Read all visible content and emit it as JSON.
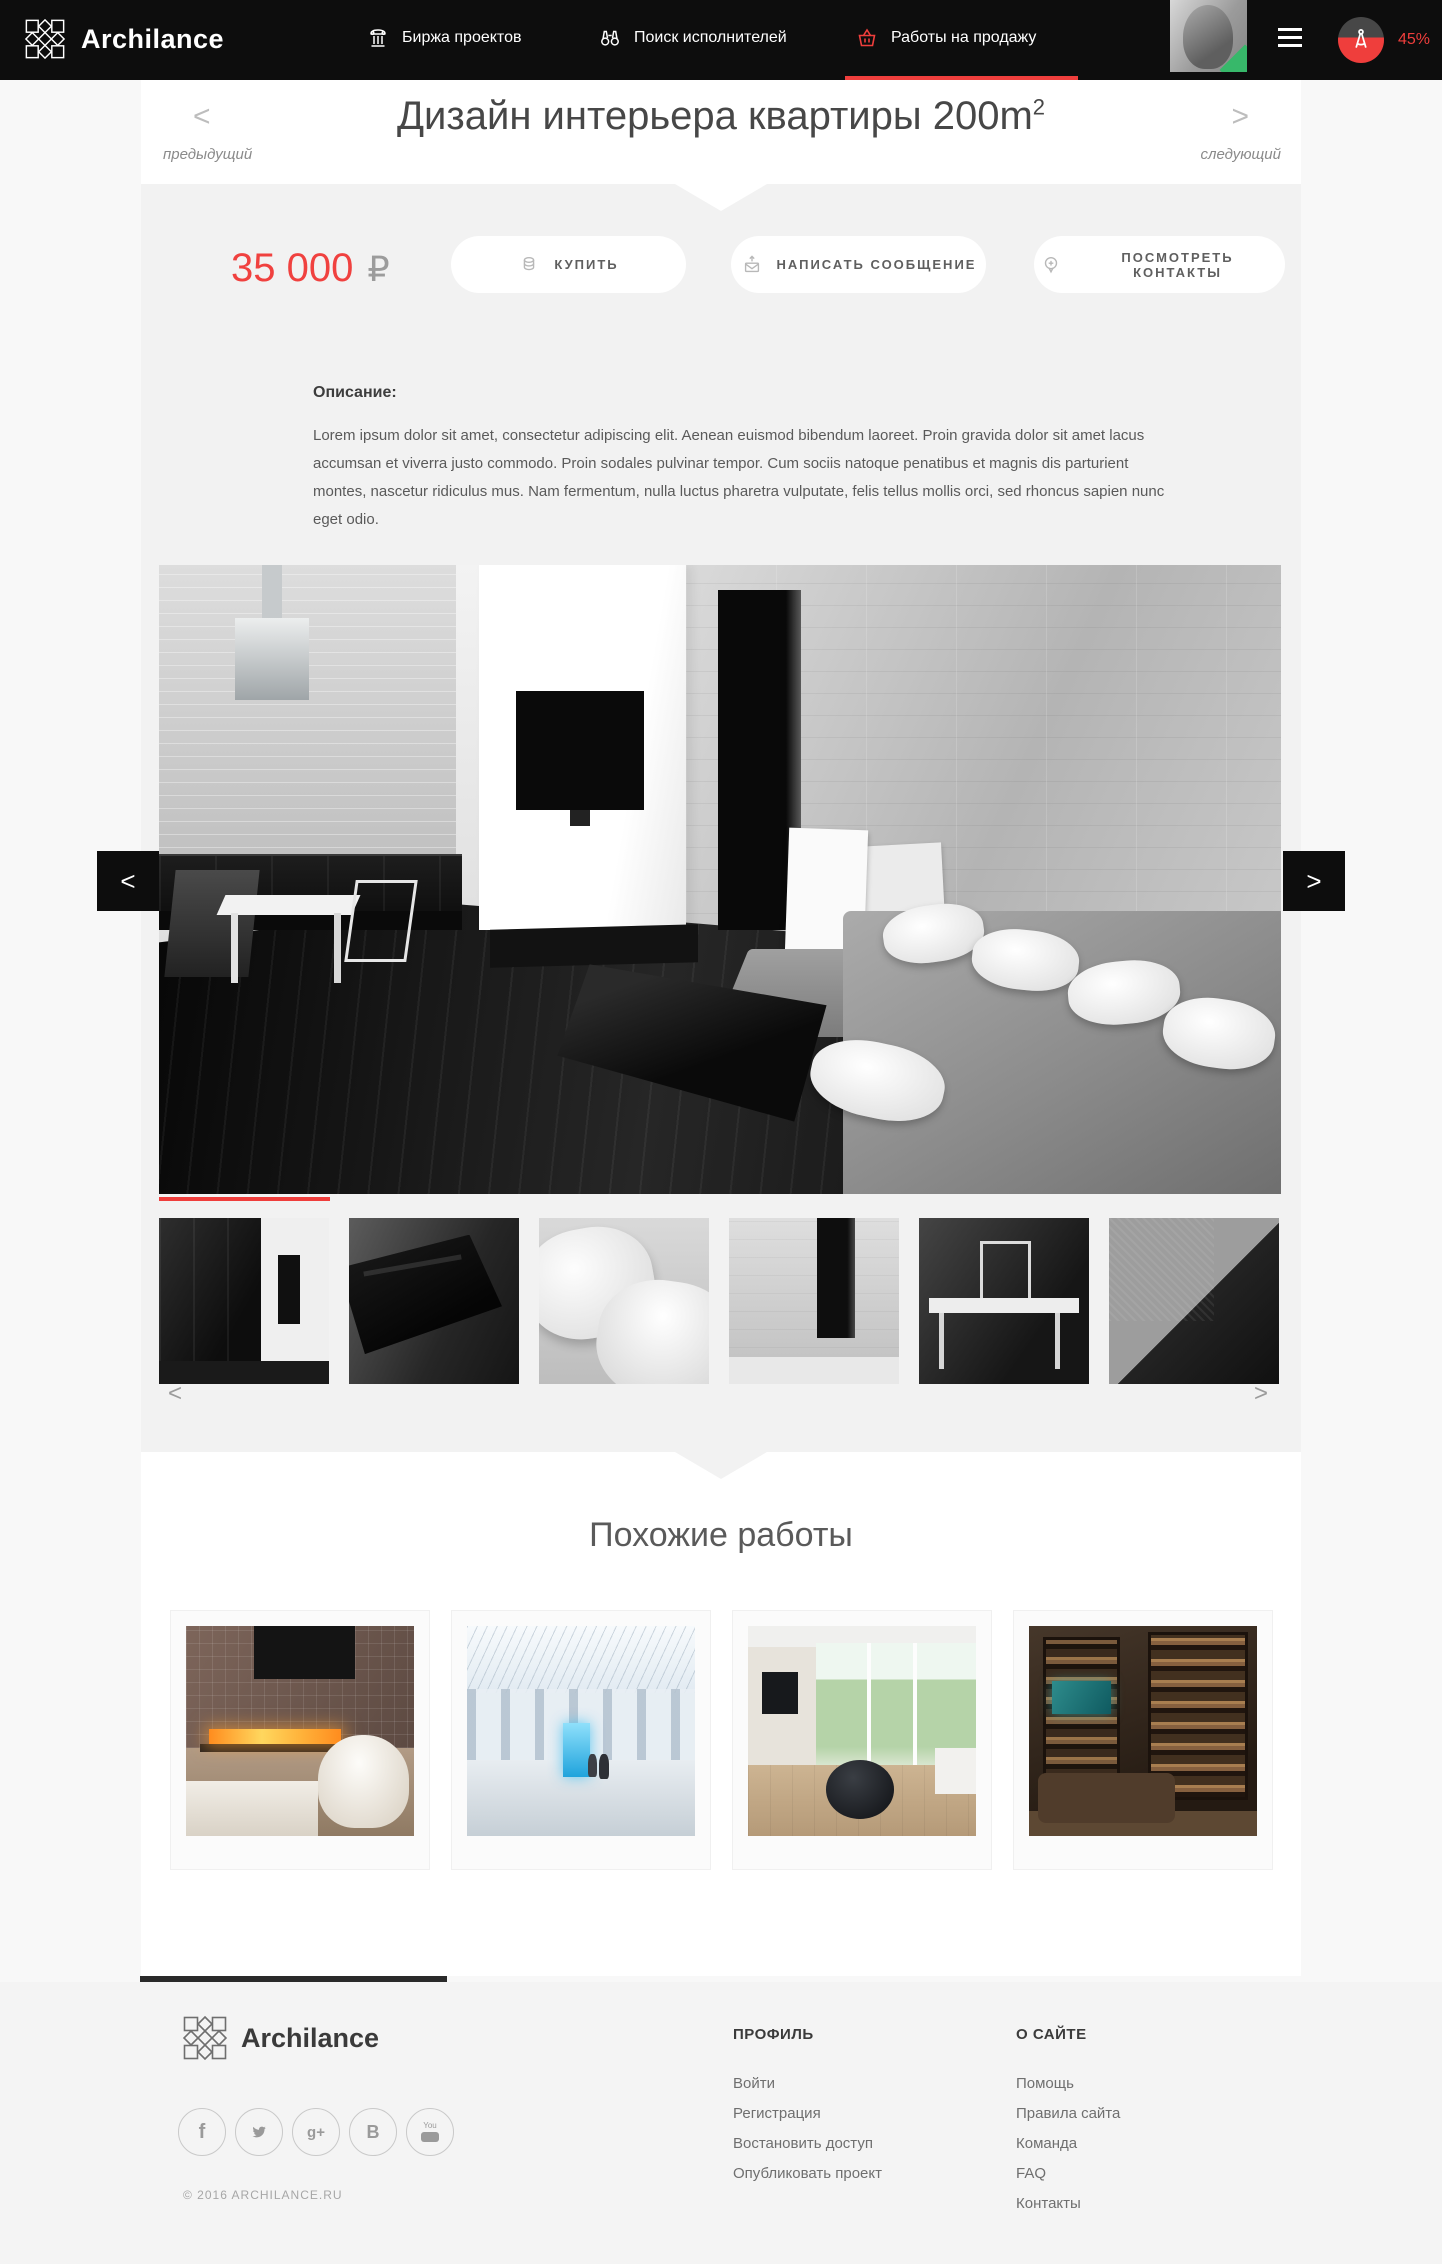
{
  "header": {
    "logo_text": "Archilance",
    "nav": [
      {
        "label": "Биржа проектов",
        "icon": "bank-icon"
      },
      {
        "label": "Поиск исполнителей",
        "icon": "binoculars-icon"
      },
      {
        "label": "Работы на продажу",
        "icon": "basket-icon",
        "active": true
      }
    ],
    "profile_completeness": "45%"
  },
  "title_bar": {
    "prev_arrow": "<",
    "prev_label": "предыдущий",
    "title": "Дизайн интерьера квартиры 200m",
    "title_sup": "2",
    "next_arrow": ">",
    "next_label": "следующий"
  },
  "purchase": {
    "price": "35 000",
    "currency": "₽",
    "buy_button": "КУПИТЬ",
    "message_button": "НАПИСАТЬ СООБЩЕНИЕ",
    "contacts_button": "ПОСМОТРЕТЬ КОНТАКТЫ"
  },
  "description": {
    "label": "Описание:",
    "text": "Lorem ipsum dolor sit amet, consectetur adipiscing elit. Aenean euismod bibendum laoreet. Proin gravida dolor sit amet lacus accumsan et viverra justo commodo. Proin sodales pulvinar tempor. Cum sociis natoque penatibus et magnis dis parturient montes, nascetur ridiculus mus. Nam fermentum, nulla luctus pharetra vulputate, felis tellus mollis orci, sed rhoncus sapien nunc eget odio."
  },
  "gallery": {
    "prev_arrow": "<",
    "next_arrow": ">",
    "main_photo": "современная гостиная с кухней, темным полом, серым диваном и черным журнальным столиком",
    "thumbs": [
      "темные кухонные фасады",
      "черный журнальный столик",
      "белые подушки",
      "бетонная стена с проемом",
      "обеденный стол со стулом",
      "угол серого дивана"
    ],
    "thumb_prev": "<",
    "thumb_next": ">"
  },
  "similar": {
    "title": "Похожие работы",
    "items": [
      {
        "name": "интерьер с камином и белым креслом"
      },
      {
        "name": "атриум торгового центра"
      },
      {
        "name": "светлая гостиная с панорамными окнами"
      },
      {
        "name": "домашняя библиотека с аквариумом"
      }
    ]
  },
  "footer": {
    "logo_text": "Archilance",
    "social": [
      "facebook",
      "twitter",
      "google-plus",
      "vk",
      "youtube"
    ],
    "social_glyphs": {
      "facebook": "f",
      "google_plus": "g+",
      "vk": "B",
      "youtube_word": "You"
    },
    "copyright": "© 2016 ARCHILANCE.RU",
    "columns": [
      {
        "title": "ПРОФИЛЬ",
        "links": [
          "Войти",
          "Регистрация",
          "Востановить доступ",
          "Опубликовать проект"
        ]
      },
      {
        "title": "О САЙТЕ",
        "links": [
          "Помощь",
          "Правила сайта",
          "Команда",
          "FAQ",
          "Контакты"
        ]
      }
    ]
  },
  "colors": {
    "accent_red": "#ef3e3c",
    "header_bg": "#0d0d0d",
    "band_bg": "#f2f2f2",
    "footer_bg": "#f4f4f4",
    "success_green": "#37b86a"
  }
}
